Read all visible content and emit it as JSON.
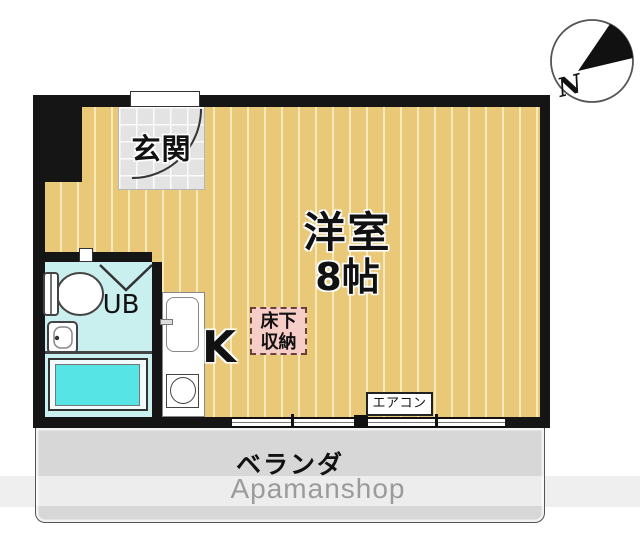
{
  "labels": {
    "entrance": "玄関",
    "main_room_name": "洋室",
    "main_room_size": "8帖",
    "unit_bath": "UB",
    "kitchen": "K",
    "floor_storage_line1": "床下",
    "floor_storage_line2": "収納",
    "air_conditioner": "エアコン",
    "veranda": "ベランダ",
    "watermark": "Apamanshop",
    "compass_north": "N"
  },
  "colors": {
    "wall": "#151515",
    "flooring": "#e9c878",
    "flooring_stripe": "#f6e9bc",
    "entrance_tile": "#e3e3e3",
    "bath_floor": "#c9efee",
    "bathtub": "#57e4e5",
    "storage_bg": "#f7cdc7",
    "storage_border": "#6b4038",
    "veranda": "#d7d7d7",
    "watermark_text": "#9b9b9b"
  }
}
